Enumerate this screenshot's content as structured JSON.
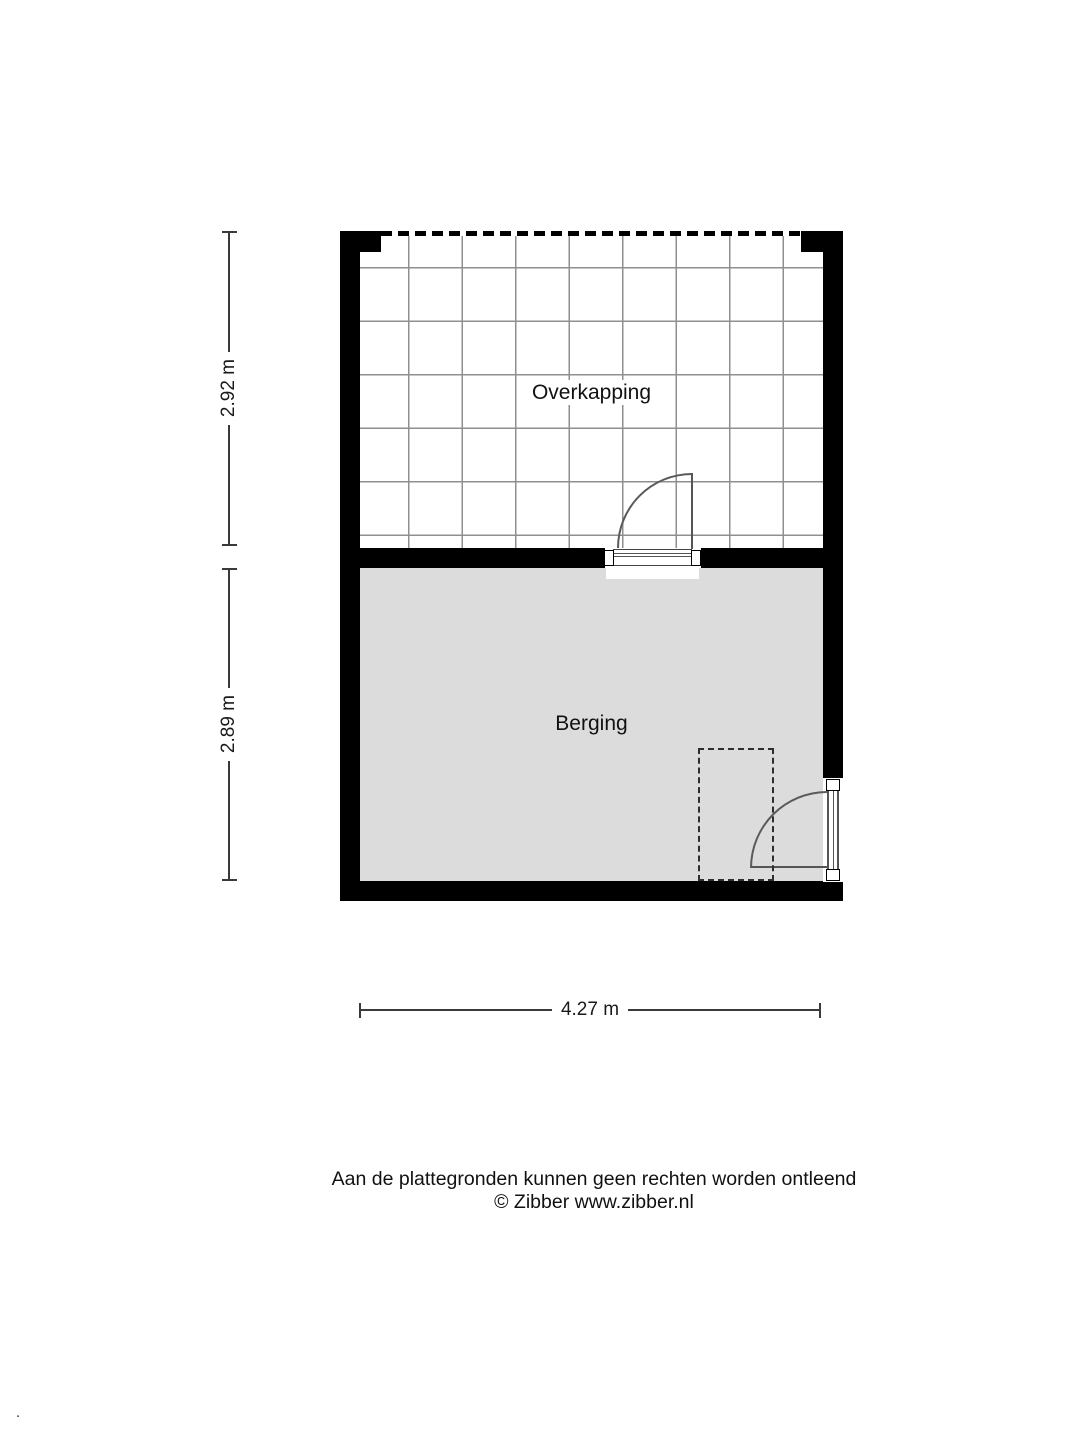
{
  "floorplan": {
    "rooms": [
      {
        "label": "Overkapping"
      },
      {
        "label": "Berging"
      }
    ],
    "dimensions": {
      "left_top": "2.92 m",
      "left_bottom": "2.89 m",
      "bottom": "4.27 m"
    },
    "icons": {
      "door_swing": "quarter-arc",
      "open_side": "dashed-line"
    },
    "colors": {
      "wall": "#000000",
      "floor_fill": "#dcdcdc",
      "grid_line": "#8f8f8f",
      "dimension_line": "#3a3a3a",
      "door_stroke": "#555555"
    }
  },
  "footer": {
    "disclaimer": "Aan de plattegronden kunnen geen rechten worden ontleend",
    "copyright": "© Zibber www.zibber.nl",
    "stray_mark": "."
  }
}
